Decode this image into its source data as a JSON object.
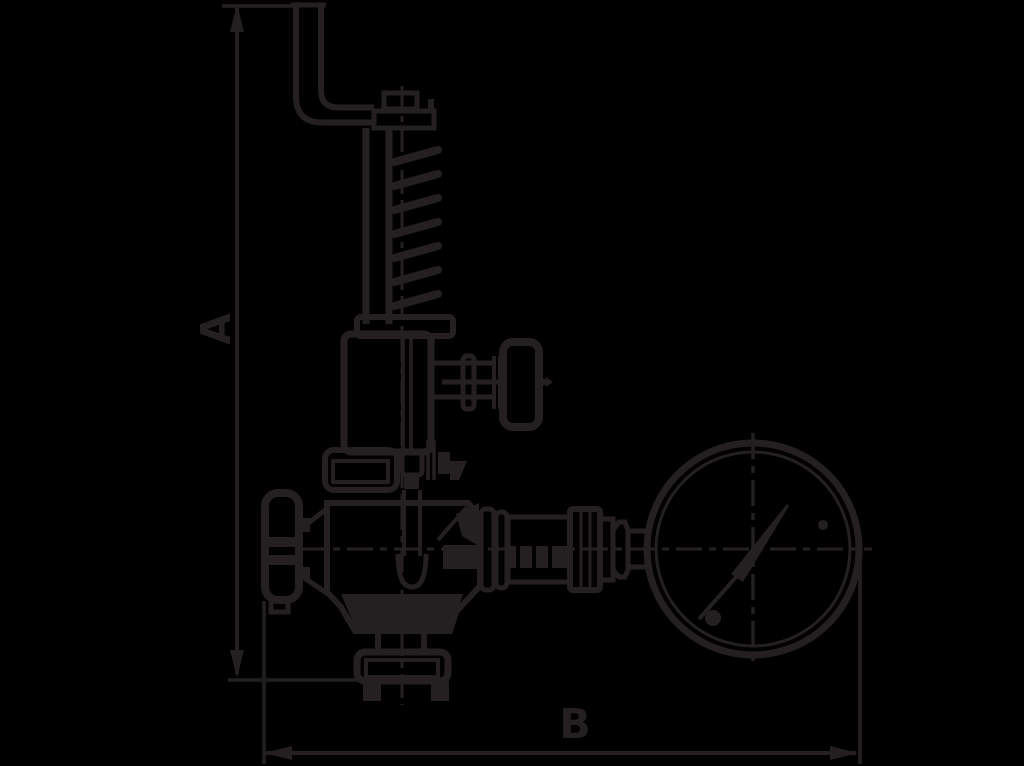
{
  "drawing": {
    "kind": "valve-with-pressure-gauge-dimension-drawing",
    "labels": {
      "height_dimension": "A",
      "width_dimension": "B"
    },
    "colors": {
      "background": "#000000",
      "ink": "#242021"
    }
  }
}
